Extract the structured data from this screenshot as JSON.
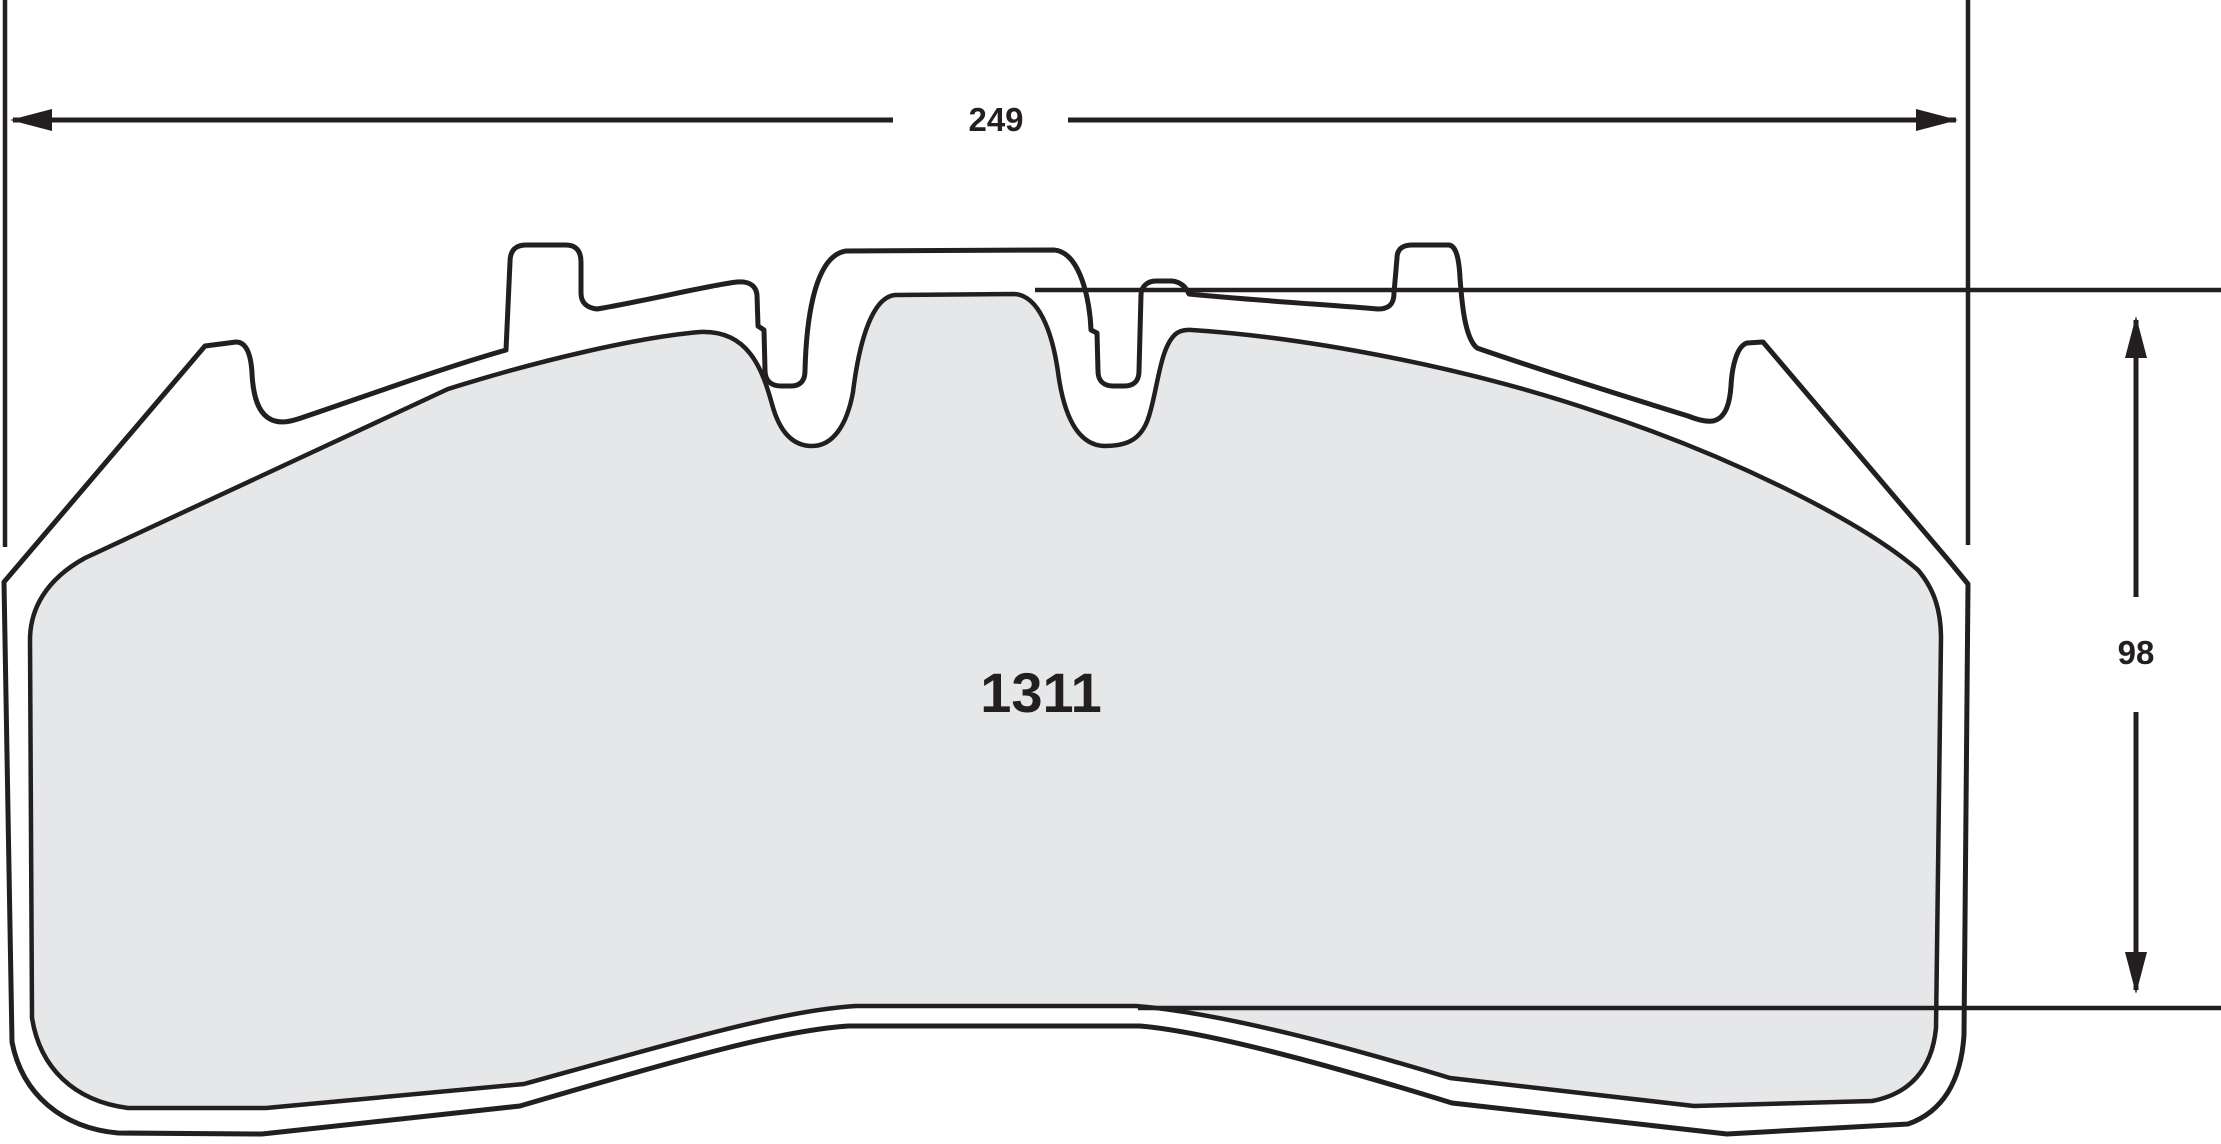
{
  "drawing": {
    "part_number": "1311",
    "width_label": "249",
    "height_label": "98"
  },
  "colors": {
    "line": "#231f20",
    "friction_fill": "#e6e7e8",
    "backplate_fill": "#ffffff"
  }
}
